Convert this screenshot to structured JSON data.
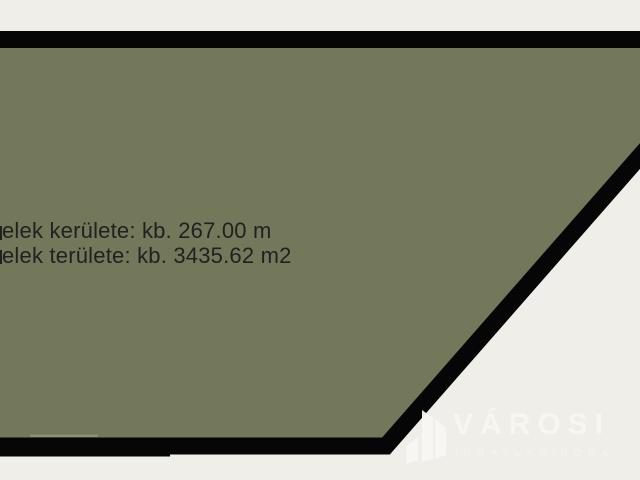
{
  "plot": {
    "perimeter_label": "elek kerülete: kb. 267.00 m",
    "area_label": "elek területe: kb. 3435.62 m2"
  },
  "watermark": {
    "name": "VÁROSI",
    "subtitle": "INGATLANIRODA",
    "icon": "building-icon"
  },
  "colors": {
    "background": "#efeee9",
    "plot_fill": "#727859",
    "plot_border": "#060606",
    "boundary_artifact": "#8e9379",
    "label_text": "#212121",
    "watermark_white": "#f8f7f3"
  }
}
